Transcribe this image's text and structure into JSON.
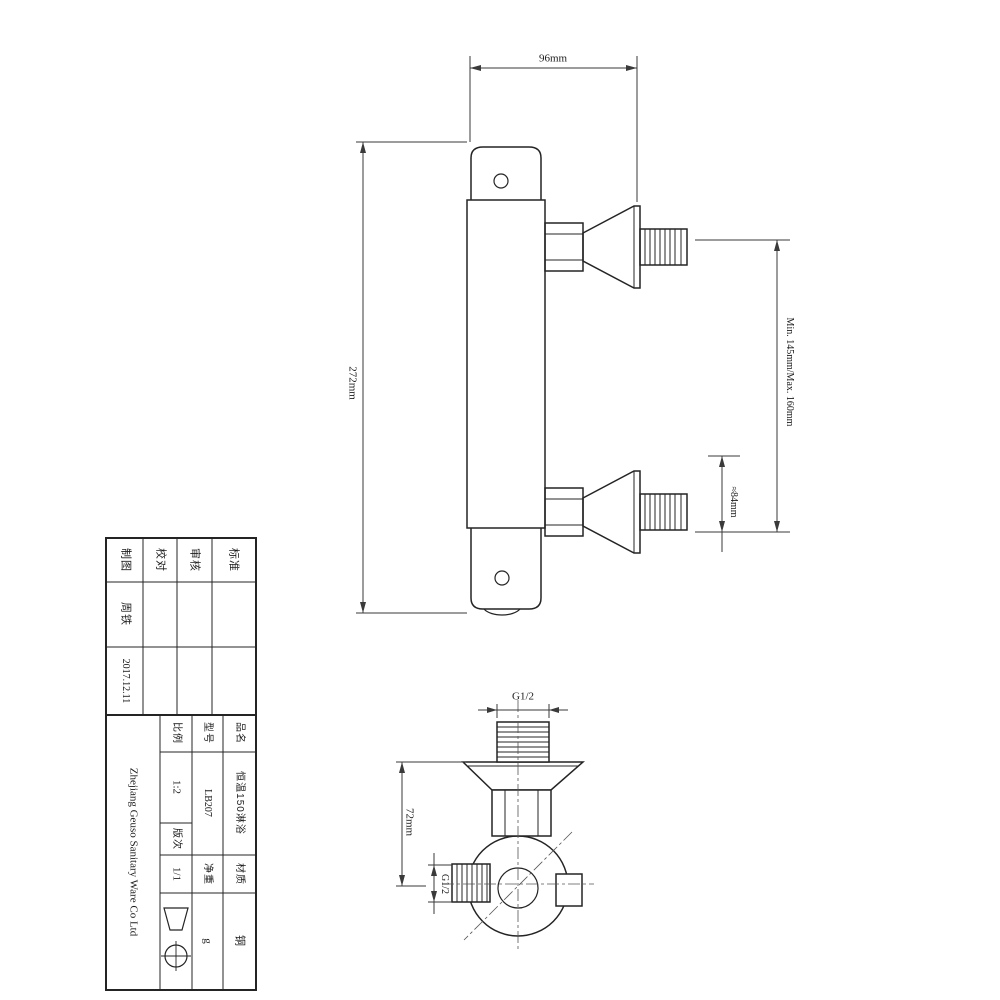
{
  "views": {
    "front": {
      "dim_width": "96mm",
      "dim_height": "272mm",
      "dim_centers": "Min. 145mm/Max. 160mm",
      "dim_offset": "≈84mm"
    },
    "side": {
      "dim_thread_top": "G1/2",
      "dim_thread_side": "G1/2",
      "dim_depth": "72mm"
    }
  },
  "title_block": {
    "approval_headers": [
      "制图",
      "校对",
      "审核",
      "标准"
    ],
    "drawn_by": "周铁",
    "date": "2017.12.11",
    "company": "Zhejiang Geuso Sanitary Ware Co Ltd",
    "scale_label": "比例",
    "scale_value": "1:2",
    "revision_label": "版次",
    "revision_value": "1/1",
    "model_label": "型号",
    "model_value": "LB207",
    "weight_label": "净重",
    "weight_value": "g",
    "product_label": "品名",
    "product_value": "恒温150淋浴",
    "material_label": "材质",
    "material_value": "铜"
  },
  "colors": {
    "line": "#2b2b2b",
    "background": "#ffffff"
  }
}
